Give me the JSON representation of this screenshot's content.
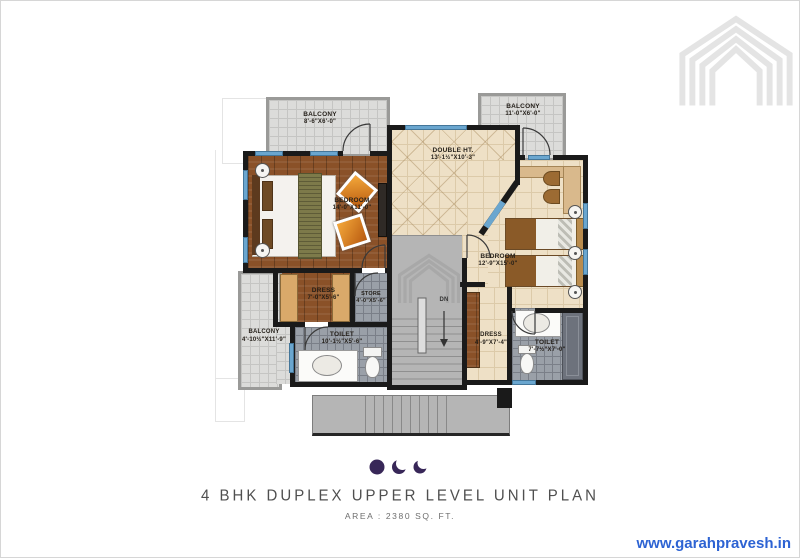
{
  "branding": {
    "website": "www.garahpravesh.in",
    "logo_name": "nested house chevron logo"
  },
  "plan": {
    "title": "4 BHK DUPLEX UPPER LEVEL UNIT PLAN",
    "area_label": "AREA : 2380 SQ. FT.",
    "rooms": {
      "balcony_tl": {
        "name": "BALCONY",
        "dims": "8'-6\"X6'-0\""
      },
      "balcony_tr": {
        "name": "BALCONY",
        "dims": "11'-0\"X6'-0\""
      },
      "double_ht": {
        "name": "DOUBLE HT.",
        "dims": "13'-1½\"X10'-3\""
      },
      "bedroom_left": {
        "name": "BEDROOM",
        "dims": "14'-0\"X11'-0\""
      },
      "bedroom_right": {
        "name": "BEDROOM",
        "dims": "12'-9\"X15'-0\""
      },
      "dress_left": {
        "name": "DRESS",
        "dims": "7'-0\"X5'-6\""
      },
      "store": {
        "name": "STORE",
        "dims": "4'-0\"X5'-6\""
      },
      "balcony_bl": {
        "name": "BALCONY",
        "dims": "4'-10½\"X11'-9\""
      },
      "toilet_left": {
        "name": "TOILET",
        "dims": "10'-1½\"X5'-6\""
      },
      "dress_right": {
        "name": "DRESS",
        "dims": "4'-9\"X7'-4\""
      },
      "toilet_right": {
        "name": "TOILET",
        "dims": "7'-7½\"X7'-0\""
      }
    },
    "stairs": {
      "dn_label": "DN"
    }
  },
  "colors": {
    "wall": "#1a1a1a",
    "window": "#6aa6cf",
    "wood": "#8a5128",
    "beige": "#eee0c6",
    "tile-light": "#dcdcda",
    "tile-dark": "#9aa0a8",
    "stair-gray": "#b5b5b5",
    "accent-purple": "#382758",
    "website-blue": "#2d63d3",
    "logo-gray": "#e4e4e4"
  }
}
